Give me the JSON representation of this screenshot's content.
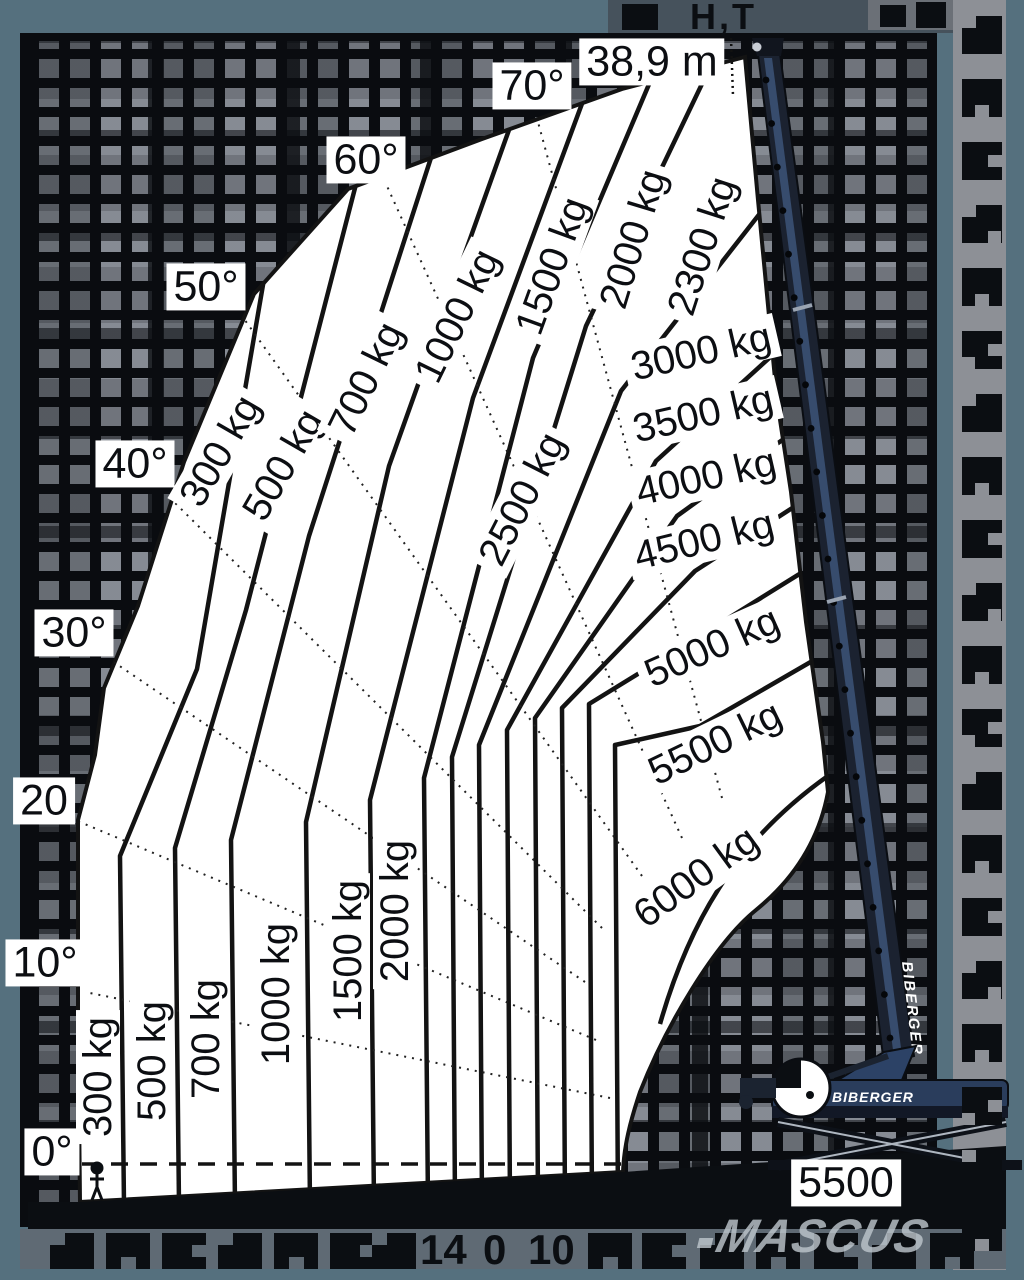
{
  "scene": {
    "header_corrupt_text": "H,T",
    "watermark": "MASCUS"
  },
  "chart": {
    "height_label": "38,9 m",
    "base_width_label": "5500",
    "angle_labels": [
      "0°",
      "10°",
      "20",
      "30°",
      "40°",
      "50°",
      "60°",
      "70°"
    ],
    "upper_load_labels": [
      "300 kg",
      "500 kg",
      "700 kg",
      "1000 kg",
      "1500 kg",
      "2000 kg",
      "2300 kg"
    ],
    "arc_load_labels": [
      "2500 kg",
      "3000 kg",
      "3500 kg",
      "4000 kg",
      "4500 kg",
      "5000 kg",
      "5500 kg",
      "6000 kg"
    ],
    "lower_load_labels": [
      "300 kg",
      "500 kg",
      "700 kg",
      "1000 kg",
      "1500 kg",
      "2000 kg"
    ],
    "axis_remnant_labels": [
      "14",
      "0",
      "10"
    ]
  },
  "machine": {
    "brand_boom_label": "BIBERGER",
    "brand_body_label": "BIBERGER"
  },
  "colors": {
    "frame": "#55707e",
    "grid_cell": "#7a8089",
    "grid_black": "#0a0c10",
    "right_strip": "#8d9096",
    "bottom_strip": "#5f6a74",
    "machine_blue": "#2a3d5c",
    "line": "#131313",
    "watermark_gray": "#bcc4cb"
  },
  "chart_data": {
    "type": "line",
    "title": "Telescopic crane load capacity envelope",
    "x_axis": "outreach (tick numbers mostly obscured)",
    "y_axis": "boom angle",
    "boom_angle_lines_deg": [
      0,
      10,
      20,
      30,
      40,
      50,
      60,
      70
    ],
    "capacity_lines_kg": [
      300,
      500,
      700,
      1000,
      1500,
      2000,
      2300,
      2500,
      3000,
      3500,
      4000,
      4500,
      5000,
      5500,
      6000
    ],
    "max_lift_height_label": "38,9 m",
    "support_base_label": "5500",
    "visible_x_tick_remnants": [
      "14",
      "0",
      "10"
    ],
    "legend_position": "labels-on-lines",
    "grid": false
  }
}
